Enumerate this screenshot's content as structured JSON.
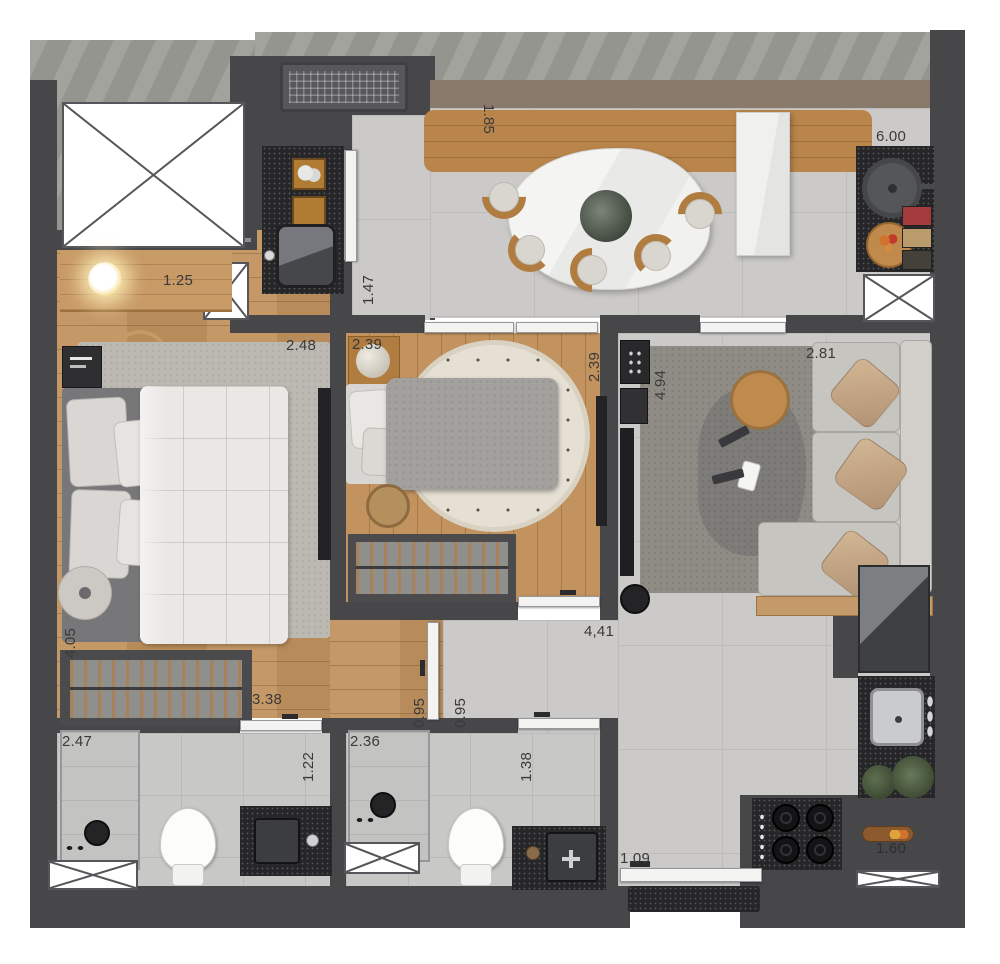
{
  "plan": {
    "type": "apartment-floor-plan-3d-top-view",
    "rooms": [
      "terrace",
      "elevator-shaft",
      "laundry",
      "dining",
      "kitchen",
      "bedroom-1",
      "bedroom-2",
      "living-room",
      "hallway",
      "bathroom-1",
      "bathroom-2",
      "entry"
    ]
  },
  "dims": {
    "dining_bench": "1.85",
    "kitchen_run": "6.00",
    "desk": "1.25",
    "service_door": "1.47",
    "bedroom1_width": "2.48",
    "bedroom1_length": "4.05",
    "bedroom1_wardrobe": "3.38",
    "bedroom2_width": "2.39",
    "bedroom2_length": "2.39",
    "living_length": "4.94",
    "living_width": "2.81",
    "hall_length": "4,41",
    "hall_width_left": "0.95",
    "hall_width_right": "0.95",
    "bath1_width": "2.47",
    "bath1_door": "1.22",
    "bath2_width": "2.36",
    "bath2_door": "1.38",
    "entry_door": "1.09",
    "kitchen_counter": "1.60"
  },
  "palette": {
    "wall": "#47474a",
    "wood_floor": "#c2935f",
    "tile_floor": "#cbcac8",
    "concrete": "#9d9d98",
    "counter_stone": "#262628",
    "balcony_band": "#8a7a6c",
    "label_text": "#3a3a3a"
  }
}
